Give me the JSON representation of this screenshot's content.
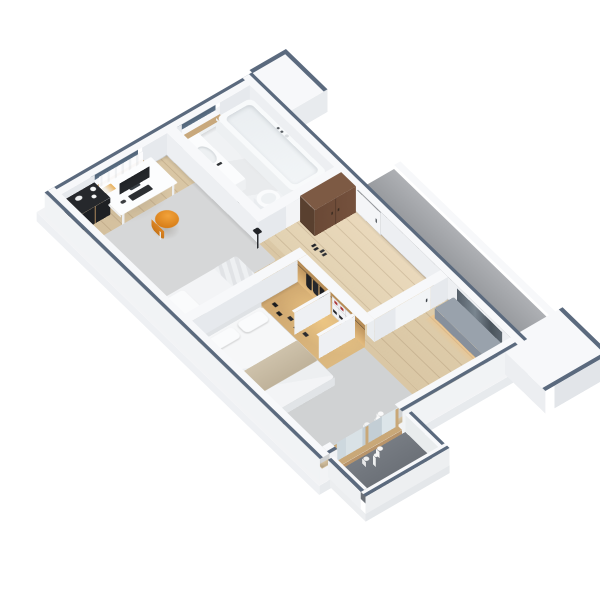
{
  "scene": {
    "description": "isometric-3d-floor-plan-render",
    "style": "cutaway-apartment-dollhouse-view",
    "background": "#ffffff"
  },
  "palette": {
    "bg": "#ffffff",
    "wall_top": "#f7f8fa",
    "wall_face_s": "#edeff2",
    "wall_face_e": "#e6e9ed",
    "wall_out": "#f1f3f5",
    "stripe": "#5b6a7e",
    "wood_a": "#dfcdab",
    "wood_b": "#d3bf9d",
    "hall_wood_a": "#ead9bc",
    "hall_wood_b": "#e1d1b1",
    "plank_line": "rgba(125,98,66,0.20)",
    "tile_a": "#f0f2f4",
    "tile_b": "#e9ebed",
    "rug_living": "#d6d7d8",
    "rug_bedroom": "#d0d2d3",
    "deck_a": "#aeb0b4",
    "deck_b": "#8d9094",
    "balcony_a": "#777c83",
    "balcony_b": "#676c73",
    "closet_back_a": "#b48a55",
    "closet_back_b": "#e5bd80",
    "closet_floor_a": "#cfa76f",
    "closet_floor_b": "#dcb980",
    "closet_glow": "rgba(255,215,140,0.55)",
    "cabinet_top": "#7d5a44",
    "cabinet_face": "#6a4936",
    "cabinet_side": "#59402f",
    "bench_top": "#99a2ac",
    "bench_face": "#87909c",
    "mirror_a": "#555f69",
    "mirror_b": "#4a535c",
    "window_glass_a": "#3f5166",
    "window_glass_b": "#5d7186",
    "window_sill_wood": "#c8a87c",
    "door_wood": "#c9a878",
    "door_wood_shade": "#b8946a",
    "chair_a": "#f2a33b",
    "chair_b": "#d77d18",
    "monitor": "#24272b",
    "keyboard": "#2c2f33",
    "shelf_black": "#26282c",
    "bed_white": "#f3f4f6",
    "bed_shade": "#e4e6e9",
    "throw_a": "#cec2ab",
    "throw_b": "#bfb29a",
    "red_accent": "#a83434"
  },
  "rooms": [
    {
      "name": "bathroom",
      "features": [
        "bathtub",
        "vanity-sink",
        "wall-hung-toilet",
        "window"
      ]
    },
    {
      "name": "entry-hall",
      "features": [
        "entry-door",
        "brown-wardrobe-cabinet",
        "bathroom-door",
        "shoes"
      ]
    },
    {
      "name": "living-study",
      "features": [
        "desk",
        "monitor",
        "keyboard",
        "orange-stool",
        "single-bed",
        "rug",
        "cubby-shelf",
        "curtain",
        "window",
        "floor-lamp"
      ]
    },
    {
      "name": "walk-in-closet",
      "features": [
        "oak-back-panel",
        "hanging-clothes",
        "shoe-shelf",
        "warm-led-glow"
      ]
    },
    {
      "name": "bedroom",
      "features": [
        "double-bed",
        "beige-throw",
        "pillows",
        "gray-bench",
        "wall-mirror",
        "rug",
        "bottle-decor"
      ]
    },
    {
      "name": "balcony",
      "features": [
        "wood-framed-glass-door",
        "parapet-walls",
        "dark-floor",
        "bottle-decor"
      ]
    },
    {
      "name": "exterior",
      "features": [
        "access-deck",
        "neighbor-wall-stub",
        "corner-pier"
      ]
    }
  ]
}
